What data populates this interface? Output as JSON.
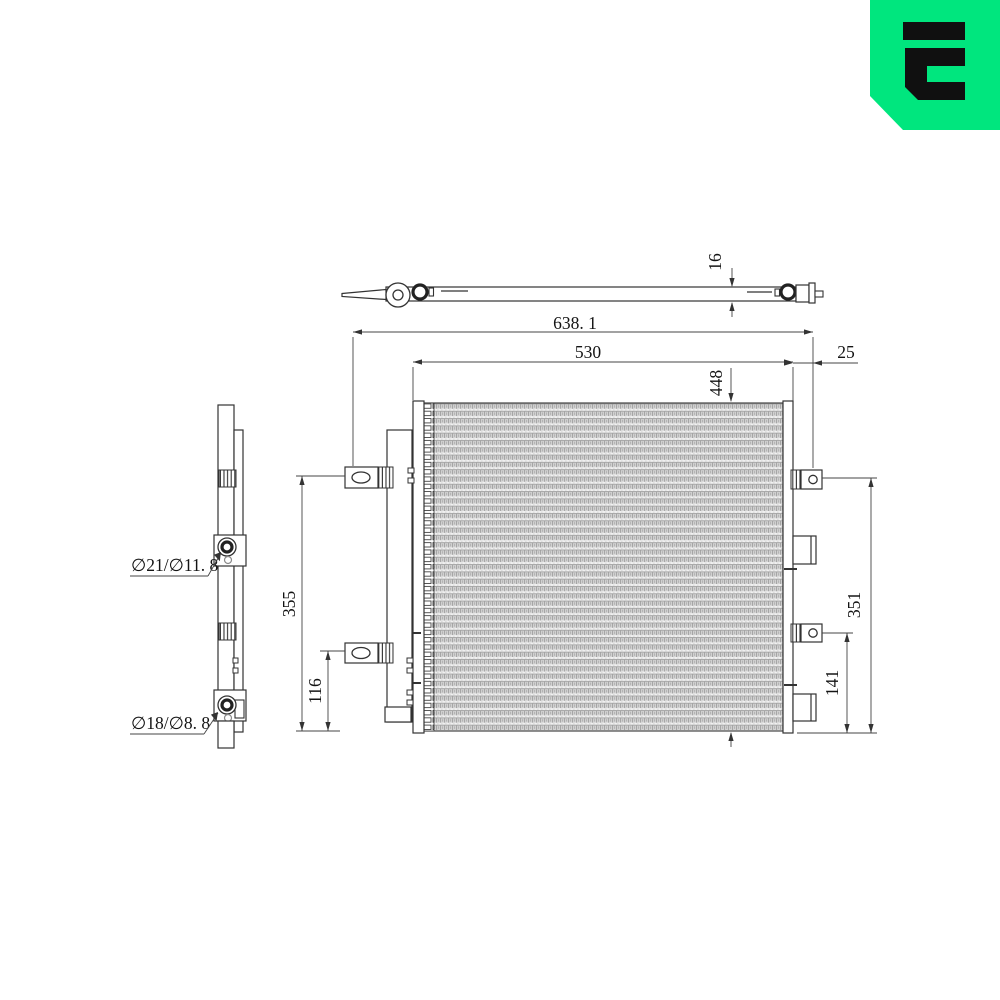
{
  "logo": {
    "name": "era-brand-logo",
    "bg_color": "#00E67E",
    "glyph_color": "#101010"
  },
  "drawing": {
    "line_color": "#333333",
    "top_view": {
      "thickness": "16"
    },
    "front_view": {
      "overall_width": "638. 1",
      "core_width": "530",
      "right_bracket_offset": "25",
      "overall_height": "448",
      "left_upper_mount_to_bottom": "355",
      "left_lower_mount_to_bottom": "116",
      "right_upper_mount_to_bottom": "351",
      "right_lower_mount_to_bottom": "141"
    },
    "side_view": {
      "upper_port": "∅21/∅11. 8",
      "lower_port": "∅18/∅8. 8"
    }
  }
}
